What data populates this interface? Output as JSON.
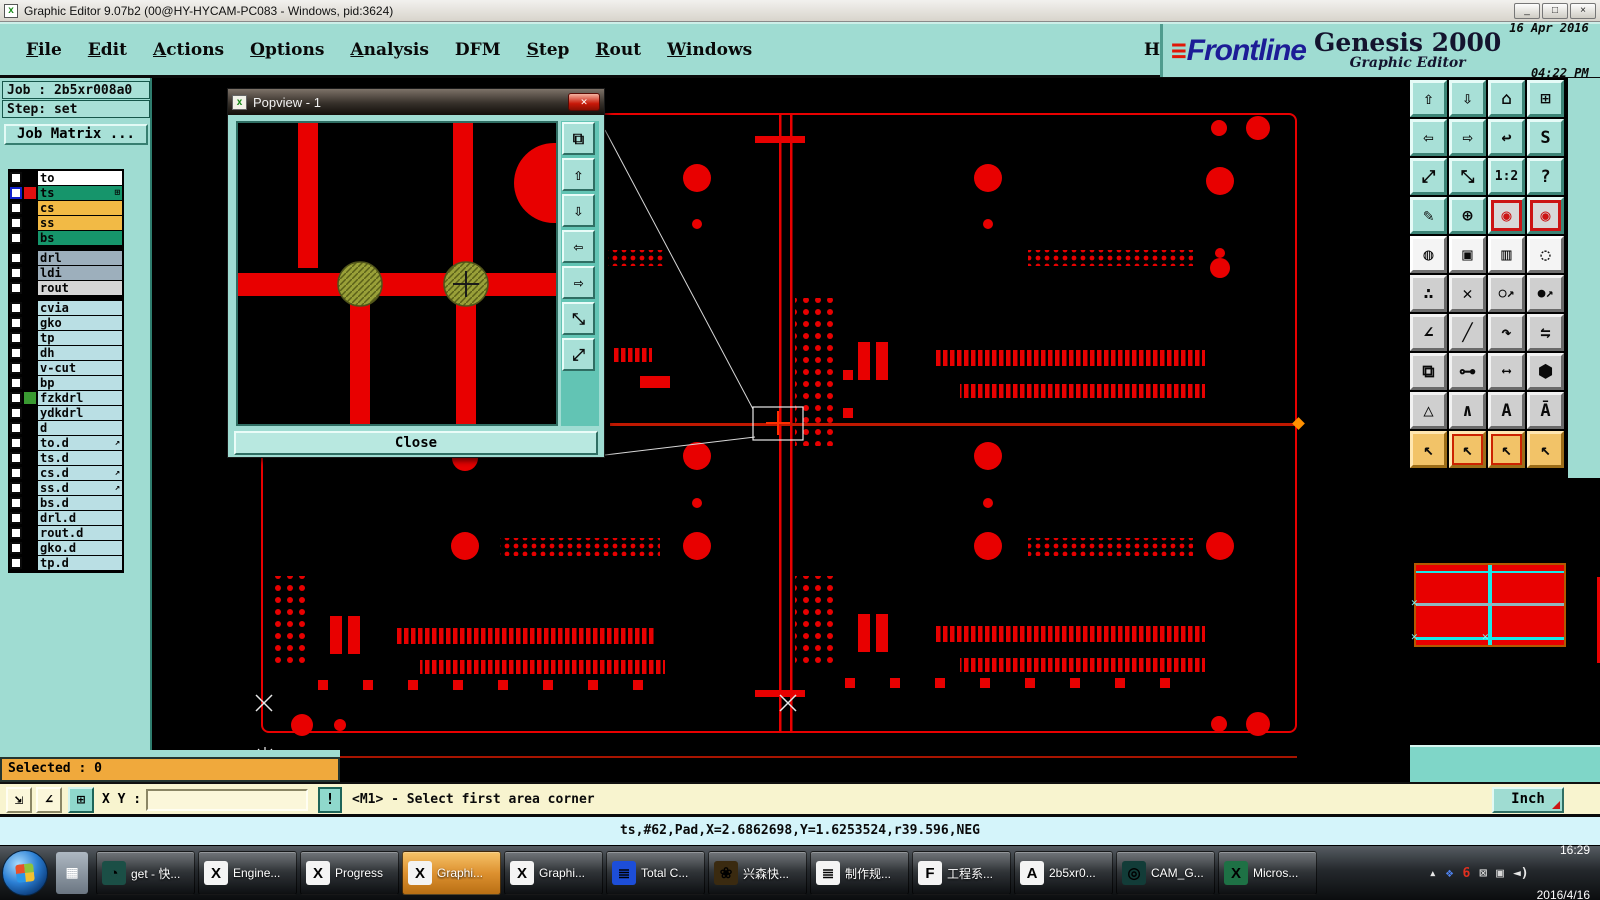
{
  "window": {
    "title": "Graphic Editor 9.07b2 (00@HY-HYCAM-PC083 - Windows, pid:3624)",
    "icon": "x",
    "controls": [
      {
        "name": "minimize-button",
        "glyph": "_"
      },
      {
        "name": "maximize-button",
        "glyph": "□"
      },
      {
        "name": "close-button",
        "glyph": "×"
      }
    ]
  },
  "menu": {
    "items": [
      {
        "label": "File"
      },
      {
        "label": "Edit"
      },
      {
        "label": "Actions"
      },
      {
        "label": "Options"
      },
      {
        "label": "Analysis"
      },
      {
        "label": "DFM",
        "cls": "no-ul"
      },
      {
        "label": "Step"
      },
      {
        "label": "Rout"
      },
      {
        "label": "Windows"
      }
    ],
    "help": "Help"
  },
  "brand": {
    "lines": "≡",
    "logo": "Frontline",
    "product": "Genesis 2000",
    "subtitle": "Graphic Editor",
    "date": "16 Apr 2016",
    "time": "04:22 PM"
  },
  "sidebar": {
    "job": "Job : 2b5xr008a0",
    "step": "Step: set",
    "matrix_button": "Job Matrix ...",
    "layers": [
      {
        "name": "to",
        "bg": "#ffffff"
      },
      {
        "name": "ts",
        "bg": "#16956b",
        "swatch": "#e01010",
        "cls": "active",
        "badge": "⊞"
      },
      {
        "name": "cs",
        "bg": "#f2ba45"
      },
      {
        "name": "ss",
        "bg": "#f2ba45"
      },
      {
        "name": "bs",
        "bg": "#16956b"
      },
      {
        "name": "drl",
        "bg": "#9dafbc",
        "cls": "gap"
      },
      {
        "name": "ldi",
        "bg": "#9dafbc"
      },
      {
        "name": "rout",
        "bg": "#d6d6d6"
      },
      {
        "name": "cvia",
        "bg": "#badfe4",
        "cls": "gap"
      },
      {
        "name": "gko",
        "bg": "#badfe4"
      },
      {
        "name": "tp",
        "bg": "#badfe4"
      },
      {
        "name": "dh",
        "bg": "#badfe4"
      },
      {
        "name": "v-cut",
        "bg": "#badfe4"
      },
      {
        "name": "bp",
        "bg": "#badfe4"
      },
      {
        "name": "fzkdrl",
        "bg": "#badfe4",
        "swatch": "#3a9a32"
      },
      {
        "name": "ydkdrl",
        "bg": "#badfe4"
      },
      {
        "name": "d",
        "bg": "#badfe4"
      },
      {
        "name": "to.d",
        "bg": "#badfe4",
        "badge": "↗"
      },
      {
        "name": "ts.d",
        "bg": "#badfe4"
      },
      {
        "name": "cs.d",
        "bg": "#badfe4",
        "badge": "↗"
      },
      {
        "name": "ss.d",
        "bg": "#badfe4",
        "badge": "↗"
      },
      {
        "name": "bs.d",
        "bg": "#badfe4"
      },
      {
        "name": "drl.d",
        "bg": "#badfe4"
      },
      {
        "name": "rout.d",
        "bg": "#badfe4"
      },
      {
        "name": "gko.d",
        "bg": "#badfe4"
      },
      {
        "name": "tp.d",
        "bg": "#badfe4"
      }
    ]
  },
  "popview": {
    "title": "Popview - 1",
    "close_label": "Close",
    "buttons": [
      {
        "name": "popview-clone-button",
        "glyph": "⧉"
      },
      {
        "name": "popview-pan-up-button",
        "glyph": "⇧"
      },
      {
        "name": "popview-pan-down-button",
        "glyph": "⇩"
      },
      {
        "name": "popview-pan-left-button",
        "glyph": "⇦"
      },
      {
        "name": "popview-pan-right-button",
        "glyph": "⇨"
      },
      {
        "name": "popview-zoom-in-button",
        "glyph": "⤡"
      },
      {
        "name": "popview-zoom-out-button",
        "glyph": "⤢"
      }
    ]
  },
  "toolbar": {
    "buttons": [
      {
        "name": "pan-up-button",
        "glyph": "⇧",
        "cls": "teal"
      },
      {
        "name": "pan-down-button",
        "glyph": "⇩",
        "cls": "teal"
      },
      {
        "name": "home-view-button",
        "glyph": "⌂",
        "cls": "teal"
      },
      {
        "name": "window-xy-button",
        "glyph": "⊞",
        "cls": "teal"
      },
      {
        "name": "pan-left-button",
        "glyph": "⇦",
        "cls": "teal"
      },
      {
        "name": "pan-right-button",
        "glyph": "⇨",
        "cls": "teal"
      },
      {
        "name": "previous-view-button",
        "glyph": "↩",
        "cls": "teal"
      },
      {
        "name": "redraw-button",
        "glyph": "S",
        "cls": "teal"
      },
      {
        "name": "zoom-out-button",
        "glyph": "⤢",
        "cls": "teal"
      },
      {
        "name": "zoom-in-button",
        "glyph": "⤡",
        "cls": "teal"
      },
      {
        "name": "zoom-1-2-button",
        "glyph": "1:2",
        "cls": "teal small"
      },
      {
        "name": "help-mode-button",
        "glyph": "?",
        "cls": "teal"
      },
      {
        "name": "setup-button",
        "glyph": "✎",
        "cls": "teal"
      },
      {
        "name": "origin-grid-button",
        "glyph": "⊕",
        "cls": "teal"
      },
      {
        "name": "layer-display-button",
        "glyph": "◉",
        "cls": "teal red"
      },
      {
        "name": "layer-display-alt-button",
        "glyph": "◉",
        "cls": "teal red"
      },
      {
        "name": "highlight-pad-button",
        "glyph": "◍",
        "cls": "white"
      },
      {
        "name": "zoom-area-button",
        "glyph": "▣",
        "cls": "white"
      },
      {
        "name": "ruler-button",
        "glyph": "▥",
        "cls": "white"
      },
      {
        "name": "select-round-button",
        "glyph": "◌",
        "cls": "white"
      },
      {
        "name": "net-points-button",
        "glyph": "∴",
        "cls": "gray"
      },
      {
        "name": "delete-x-button",
        "glyph": "✕",
        "cls": "gray"
      },
      {
        "name": "move-open-button",
        "glyph": "○↗",
        "cls": "gray small"
      },
      {
        "name": "move-solid-button",
        "glyph": "●↗",
        "cls": "gray small"
      },
      {
        "name": "angle-button",
        "glyph": "∠",
        "cls": "gray"
      },
      {
        "name": "slope-button",
        "glyph": "╱",
        "cls": "gray"
      },
      {
        "name": "arc-button",
        "glyph": "↷",
        "cls": "gray"
      },
      {
        "name": "mirror-button",
        "glyph": "⇋",
        "cls": "gray"
      },
      {
        "name": "copy-pad-button",
        "glyph": "⧉",
        "cls": "gray"
      },
      {
        "name": "stretch-button",
        "glyph": "⊶",
        "cls": "gray"
      },
      {
        "name": "measure-distance-button",
        "glyph": "⟷",
        "cls": "gray small"
      },
      {
        "name": "surface-button",
        "glyph": "⬢",
        "cls": "gray"
      },
      {
        "name": "select-triangle-button",
        "glyph": "△",
        "cls": "gray"
      },
      {
        "name": "select-chevron-button",
        "glyph": "∧",
        "cls": "gray"
      },
      {
        "name": "select-arch-button",
        "glyph": "A",
        "cls": "gray"
      },
      {
        "name": "select-arch-ticks-button",
        "glyph": "Ā",
        "cls": "gray"
      },
      {
        "name": "pointer-button",
        "glyph": "↖",
        "cls": "orange"
      },
      {
        "name": "pointer-box-button",
        "glyph": "↖",
        "cls": "orange boxed"
      },
      {
        "name": "pointer-poly-button",
        "glyph": "↖",
        "cls": "orange boxed"
      },
      {
        "name": "pointer-net-button",
        "glyph": "↖",
        "cls": "orange"
      }
    ]
  },
  "readout": {
    "x": "X = 2.711369\"",
    "y": "Y = 0.404644\""
  },
  "status": {
    "selected": "Selected : 0",
    "xy_label": "X Y :",
    "xy_value": "",
    "excl": "!",
    "prompt": "<M1> - Select first area corner",
    "units": "Inch",
    "message": "ts,#62,Pad,X=2.6862698,Y=1.6253524,r39.596,NEG"
  },
  "bottom_controls": [
    {
      "name": "snap-corner-button",
      "glyph": "⇲",
      "cls": ""
    },
    {
      "name": "snap-angle-button",
      "glyph": "∠",
      "cls": ""
    },
    {
      "name": "grid-window-button",
      "glyph": "⊞",
      "cls": "on"
    }
  ],
  "taskbar": {
    "items": [
      {
        "label": "get - 快...",
        "glyph": "◔",
        "ibg": "#1b4f46",
        "ifg": "#7fe0c8"
      },
      {
        "label": "Engine...",
        "glyph": "X",
        "ibg": "#f4f4f4",
        "ifg": "#c8a800"
      },
      {
        "label": "Progress",
        "glyph": "X",
        "ibg": "#f4f4f4",
        "ifg": "#c8a800"
      },
      {
        "label": "Graphi...",
        "glyph": "X",
        "ibg": "#f4f4f4",
        "ifg": "#c8a800",
        "cls": "active"
      },
      {
        "label": "Graphi...",
        "glyph": "X",
        "ibg": "#f4f4f4",
        "ifg": "#c8a800"
      },
      {
        "label": "Total C...",
        "glyph": "≣",
        "ibg": "#1d4ed8",
        "ifg": "#ffffff"
      },
      {
        "label": "兴森快...",
        "glyph": "❀",
        "ibg": "#3a2a10",
        "ifg": "#e8b84b"
      },
      {
        "label": "制作规...",
        "glyph": "≣",
        "ibg": "#f4f4f4",
        "ifg": "#3b82f6"
      },
      {
        "label": "工程系...",
        "glyph": "F",
        "ibg": "#f4f4f4",
        "ifg": "#18a048"
      },
      {
        "label": "2b5xr0...",
        "glyph": "A",
        "ibg": "#f4f4f4",
        "ifg": "#d97706"
      },
      {
        "label": "CAM_G...",
        "glyph": "◎",
        "ibg": "#123c38",
        "ifg": "#e8c84b"
      },
      {
        "label": "Micros...",
        "glyph": "X",
        "ibg": "#1e7145",
        "ifg": "#ffffff"
      }
    ],
    "tray": [
      {
        "name": "tray-expand-icon",
        "glyph": "▴",
        "color": "#e8e8e8"
      },
      {
        "name": "tray-app-icon",
        "glyph": "❖",
        "color": "#4d7fe8"
      },
      {
        "name": "tray-thunder-icon",
        "glyph": "6",
        "color": "#e03020"
      },
      {
        "name": "tray-network-error-icon",
        "glyph": "⊠",
        "color": "#d8d8d8"
      },
      {
        "name": "tray-network-icon",
        "glyph": "▣",
        "color": "#d8d8d8"
      },
      {
        "name": "tray-volume-icon",
        "glyph": "◄)",
        "color": "#e8e8e8"
      }
    ],
    "clock": {
      "time": "16:29",
      "date": "2016/4/16"
    }
  }
}
